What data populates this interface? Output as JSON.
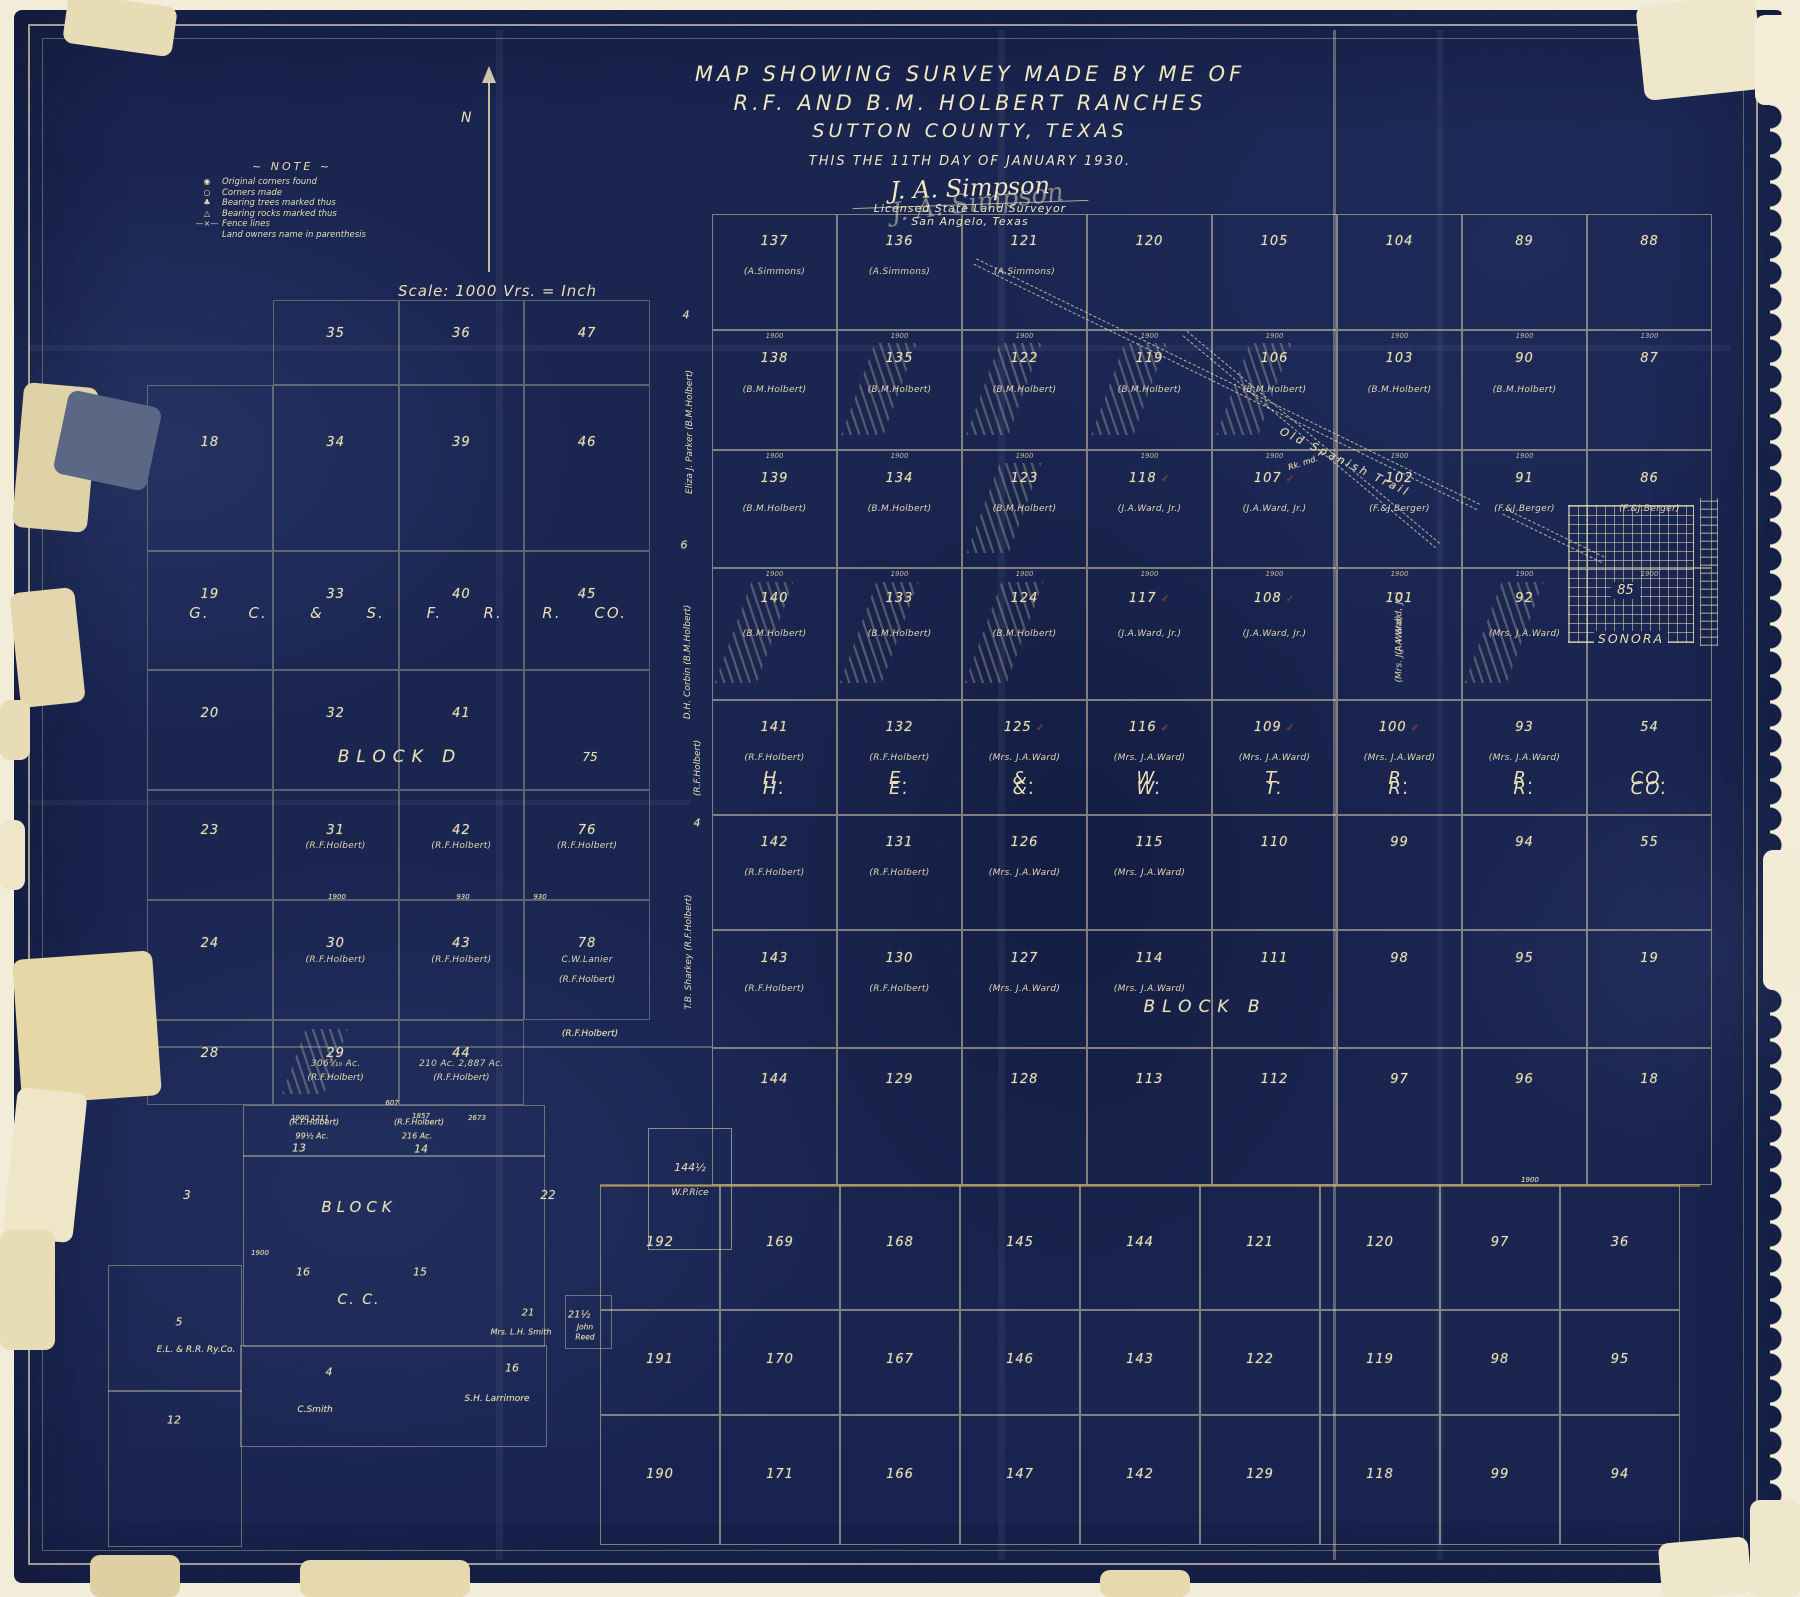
{
  "colors": {
    "field_navy": "#1a2550",
    "line_cream": "#e9ddb0",
    "text_cream": "#eadfb4",
    "crease_gold": "#caa94e",
    "check_red": "#8a2820",
    "patch_beige": "#e6d7a6",
    "tape_blue": "#5b6784"
  },
  "title": {
    "line1": "MAP SHOWING SURVEY MADE BY ME OF",
    "line2": "R.F. AND B.M. HOLBERT RANCHES",
    "line3": "SUTTON COUNTY, TEXAS",
    "line4": "THIS THE 11TH DAY OF JANUARY 1930.",
    "signature": "J. A. Simpson",
    "cred1": "Licensed State Land Surveyor",
    "cred2": "San Angelo, Texas"
  },
  "north_label": "N",
  "scale_text": "Scale: 1000 Vrs. = Inch",
  "note": {
    "heading": "~ NOTE ~",
    "items": [
      {
        "icon": "◉",
        "icon_name": "original-corner-icon",
        "text": "Original corners found"
      },
      {
        "icon": "○",
        "icon_name": "corner-made-icon",
        "text": "Corners made"
      },
      {
        "icon": "♣",
        "icon_name": "bearing-tree-icon",
        "text": "Bearing trees marked thus"
      },
      {
        "icon": "△",
        "icon_name": "bearing-rock-icon",
        "text": "Bearing rocks marked thus"
      },
      {
        "icon": "—×—",
        "icon_name": "fence-line-icon",
        "text": "Fence lines"
      },
      {
        "icon": "",
        "icon_name": "",
        "text": "Land owners name in parenthesis"
      }
    ]
  },
  "left_grid": {
    "rr_letters": [
      "G.",
      "C.",
      "&",
      "S.",
      "F.",
      "R.",
      "R.",
      "CO."
    ],
    "rows": [
      [
        {
          "e": 1
        },
        {
          "n": "35"
        },
        {
          "n": "36"
        },
        {
          "n": "47"
        }
      ],
      [
        {
          "n": "18"
        },
        {
          "n": "34"
        },
        {
          "n": "39"
        },
        {
          "n": "46"
        }
      ],
      [
        {
          "n": "19"
        },
        {
          "n": "33"
        },
        {
          "n": "40"
        },
        {
          "n": "45"
        }
      ],
      [
        {
          "n": "20"
        },
        {
          "n": "32"
        },
        {
          "n": "41"
        },
        {
          "n": ""
        }
      ],
      [
        {
          "n": "23"
        },
        {
          "n": "31",
          "o": "(R.F.Holbert)"
        },
        {
          "n": "42",
          "o": "(R.F.Holbert)"
        },
        {
          "n": "76",
          "o": "(R.F.Holbert)"
        }
      ],
      [
        {
          "n": "24"
        },
        {
          "n": "30",
          "o": "(R.F.Holbert)"
        },
        {
          "n": "43",
          "o": "(R.F.Holbert)"
        },
        {
          "n": "78",
          "o": "C.W.Lanier",
          "o2": "(R.F.Holbert)"
        }
      ],
      [
        {
          "n": "28"
        },
        {
          "n": "29",
          "o": "306⁷⁄₁₀ Ac.",
          "o2": "(R.F.Holbert)",
          "h": 1
        },
        {
          "n": "44",
          "o": "210 Ac.   2,887 Ac.",
          "o2": "(R.F.Holbert)"
        },
        {
          "e": 1
        }
      ]
    ]
  },
  "main_grid": {
    "rr_letters": [
      "H.",
      "E.",
      "&.",
      "W.",
      "T.",
      "R.",
      "R.",
      "CO."
    ],
    "rows": [
      [
        {
          "n": "137",
          "o": "(A.Simmons)"
        },
        {
          "n": "136",
          "o": "(A.Simmons)"
        },
        {
          "n": "121",
          "o": "(A.Simmons)"
        },
        {
          "n": "120"
        },
        {
          "n": "105"
        },
        {
          "n": "104"
        },
        {
          "n": "89"
        },
        {
          "n": "88"
        }
      ],
      [
        {
          "n": "138",
          "o": "(B.M.Holbert)",
          "d": "1900"
        },
        {
          "n": "135",
          "o": "(B.M.Holbert)",
          "d": "1900",
          "h": 1
        },
        {
          "n": "122",
          "o": "(B.M.Holbert)",
          "d": "1900",
          "h": 1
        },
        {
          "n": "119",
          "o": "(B.M.Holbert)",
          "d": "1900",
          "h": 1
        },
        {
          "n": "106",
          "o": "(B.M.Holbert)",
          "d": "1900",
          "h": 1
        },
        {
          "n": "103",
          "o": "(B.M.Holbert)",
          "d": "1900"
        },
        {
          "n": "90",
          "o": "(B.M.Holbert)",
          "d": "1900"
        },
        {
          "n": "87",
          "d": "1300"
        }
      ],
      [
        {
          "n": "139",
          "o": "(B.M.Holbert)",
          "d": "1900"
        },
        {
          "n": "134",
          "o": "(B.M.Holbert)",
          "d": "1900"
        },
        {
          "n": "123",
          "o": "(B.M.Holbert)",
          "d": "1900",
          "h": 1
        },
        {
          "n": "118",
          "o": "(J.A.Ward, Jr.)",
          "d": "1900",
          "c": 1
        },
        {
          "n": "107",
          "o": "(J.A.Ward, Jr.)",
          "d": "1900",
          "c": 1
        },
        {
          "n": "102",
          "o": "(F.&J.Berger)",
          "d": "1900"
        },
        {
          "n": "91",
          "o": "(F.&J.Berger)",
          "d": "1900"
        },
        {
          "n": "86",
          "o": "(F.&J.Berger)"
        }
      ],
      [
        {
          "n": "140",
          "o": "(B.M.Holbert)",
          "d": "1900",
          "h": 1
        },
        {
          "n": "133",
          "o": "(B.M.Holbert)",
          "d": "1900",
          "h": 1
        },
        {
          "n": "124",
          "o": "(B.M.Holbert)",
          "d": "1900",
          "h": 1
        },
        {
          "n": "117",
          "o": "(J.A.Ward, Jr.)",
          "d": "1900",
          "c": 1
        },
        {
          "n": "108",
          "o": "(J.A.Ward, Jr.)",
          "d": "1900",
          "c": 1
        },
        {
          "n": "101",
          "o": "(J.A.Ward, Jr.)",
          "o2": "(Mrs. J.A.Ward)",
          "v": 1,
          "d": "1900"
        },
        {
          "n": "92",
          "o": "(Mrs. J.A.Ward)",
          "d": "1900",
          "h": 1
        },
        {
          "n": "",
          "d": "1900"
        }
      ],
      [
        {
          "n": "141",
          "o": "(R.F.Holbert)",
          "b": "H."
        },
        {
          "n": "132",
          "o": "(R.F.Holbert)",
          "b": "E."
        },
        {
          "n": "125",
          "o": "(Mrs. J.A.Ward)",
          "c": 1,
          "b": "&."
        },
        {
          "n": "116",
          "o": "(Mrs. J.A.Ward)",
          "c": 1,
          "b": "W."
        },
        {
          "n": "109",
          "o": "(Mrs. J.A.Ward)",
          "c": 1,
          "b": "T."
        },
        {
          "n": "100",
          "o": "(Mrs. J.A.Ward)",
          "c": 1,
          "b": "R."
        },
        {
          "n": "93",
          "o": "(Mrs. J.A.Ward)",
          "b": "R."
        },
        {
          "n": "54",
          "b": "CO."
        }
      ],
      [
        {
          "n": "142",
          "o": "(R.F.Holbert)"
        },
        {
          "n": "131",
          "o": "(R.F.Holbert)"
        },
        {
          "n": "126",
          "o": "(Mrs. J.A.Ward)"
        },
        {
          "n": "115",
          "o": "(Mrs. J.A.Ward)"
        },
        {
          "n": "110"
        },
        {
          "n": "99"
        },
        {
          "n": "94"
        },
        {
          "n": "55"
        }
      ],
      [
        {
          "n": "143",
          "o": "(R.F.Holbert)"
        },
        {
          "n": "130",
          "o": "(R.F.Holbert)"
        },
        {
          "n": "127",
          "o": "(Mrs. J.A.Ward)"
        },
        {
          "n": "114",
          "o": "(Mrs. J.A.Ward)"
        },
        {
          "n": "111"
        },
        {
          "n": "98"
        },
        {
          "n": "95"
        },
        {
          "n": "19"
        }
      ],
      [
        {
          "n": "144"
        },
        {
          "n": "129"
        },
        {
          "n": "128"
        },
        {
          "n": "113"
        },
        {
          "n": "112"
        },
        {
          "n": "97"
        },
        {
          "n": "96"
        },
        {
          "n": "18"
        }
      ]
    ]
  },
  "bottom_grid": {
    "rows": [
      [
        "192",
        "169",
        "168",
        "145",
        "144",
        "121",
        "120",
        "97",
        "36"
      ],
      [
        "191",
        "170",
        "167",
        "146",
        "143",
        "122",
        "119",
        "98",
        "95"
      ],
      [
        "190",
        "171",
        "166",
        "147",
        "142",
        "129",
        "118",
        "99",
        "94"
      ]
    ]
  },
  "sonora": {
    "num": "85",
    "name": "SONORA"
  },
  "rice": {
    "num": "144½",
    "name": "W.P.Rice"
  },
  "margin_labels": [
    {
      "l1": "Eliza J. Parker",
      "l2": "(B.M.Holbert)",
      "x": 690,
      "y": 432
    },
    {
      "l1": "D.H. Corbin",
      "l2": "(B.M.Holbert)",
      "x": 688,
      "y": 662
    },
    {
      "l1": "(R.F.Holbert)",
      "l2": "",
      "x": 698,
      "y": 768
    },
    {
      "l1": "T.B. Sharkey",
      "l2": "(R.F.Holbert)",
      "x": 689,
      "y": 952
    }
  ],
  "annotations": [
    {
      "t": "BLOCK  D",
      "x": 400,
      "y": 757,
      "s": 17,
      "sp": 7
    },
    {
      "t": "BLOCK  B",
      "x": 1205,
      "y": 1007,
      "s": 17,
      "sp": 7
    },
    {
      "t": "Old  Spanish  Trail",
      "x": 1345,
      "y": 462,
      "s": 11,
      "r": 26,
      "sp": 3
    },
    {
      "t": "4",
      "x": 686,
      "y": 315,
      "s": 11
    },
    {
      "t": "6",
      "x": 684,
      "y": 545,
      "s": 11
    },
    {
      "t": "4",
      "x": 697,
      "y": 823,
      "s": 11
    },
    {
      "t": "75",
      "x": 590,
      "y": 757,
      "s": 12
    },
    {
      "t": "BLOCK",
      "x": 359,
      "y": 1207,
      "s": 15,
      "sp": 5
    },
    {
      "t": "C.  C.",
      "x": 359,
      "y": 1300,
      "s": 14,
      "sp": 2
    },
    {
      "t": "3",
      "x": 187,
      "y": 1195,
      "s": 12
    },
    {
      "t": "22",
      "x": 548,
      "y": 1195,
      "s": 12
    },
    {
      "t": "16",
      "x": 303,
      "y": 1272,
      "s": 11
    },
    {
      "t": "15",
      "x": 420,
      "y": 1272,
      "s": 11
    },
    {
      "t": "13",
      "x": 299,
      "y": 1148,
      "s": 11
    },
    {
      "t": "14",
      "x": 421,
      "y": 1149,
      "s": 11
    },
    {
      "t": "(R.F.Holbert)",
      "x": 314,
      "y": 1122,
      "s": 8
    },
    {
      "t": "99½ Ac.",
      "x": 312,
      "y": 1136,
      "s": 8
    },
    {
      "t": "(R.F.Holbert)",
      "x": 419,
      "y": 1122,
      "s": 8
    },
    {
      "t": "216 Ac.",
      "x": 417,
      "y": 1136,
      "s": 8
    },
    {
      "t": "21",
      "x": 528,
      "y": 1313,
      "s": 10
    },
    {
      "t": "21½",
      "x": 579,
      "y": 1315,
      "s": 10
    },
    {
      "t": "Mrs. L.H. Smith",
      "x": 521,
      "y": 1332,
      "s": 8
    },
    {
      "t": "John",
      "x": 585,
      "y": 1327,
      "s": 7.5
    },
    {
      "t": "Reed",
      "x": 585,
      "y": 1337,
      "s": 7.5
    },
    {
      "t": "5",
      "x": 179,
      "y": 1322,
      "s": 11
    },
    {
      "t": "E.L. & R.R. Ry.Co.",
      "x": 196,
      "y": 1350,
      "s": 9
    },
    {
      "t": "4",
      "x": 329,
      "y": 1372,
      "s": 11
    },
    {
      "t": "C.Smith",
      "x": 315,
      "y": 1410,
      "s": 9
    },
    {
      "t": "16",
      "x": 512,
      "y": 1368,
      "s": 11
    },
    {
      "t": "S.H. Larrimore",
      "x": 497,
      "y": 1399,
      "s": 9
    },
    {
      "t": "12",
      "x": 174,
      "y": 1420,
      "s": 11
    },
    {
      "t": "Rk. md.",
      "x": 1303,
      "y": 463,
      "s": 8,
      "r": -18
    },
    {
      "t": "(R.F.Holbert)",
      "x": 590,
      "y": 1034,
      "s": 9
    },
    {
      "t": "1900",
      "x": 337,
      "y": 897,
      "s": 7
    },
    {
      "t": "930",
      "x": 463,
      "y": 897,
      "s": 7
    },
    {
      "t": "930",
      "x": 540,
      "y": 897,
      "s": 7
    },
    {
      "t": "1900  1211",
      "x": 310,
      "y": 1118,
      "s": 7
    },
    {
      "t": "1857",
      "x": 421,
      "y": 1116,
      "s": 7
    },
    {
      "t": "2673",
      "x": 477,
      "y": 1118,
      "s": 7
    },
    {
      "t": "607",
      "x": 392,
      "y": 1103,
      "s": 7
    },
    {
      "t": "1900",
      "x": 260,
      "y": 1253,
      "s": 7
    },
    {
      "t": "1900",
      "x": 1530,
      "y": 1180,
      "s": 7
    }
  ]
}
